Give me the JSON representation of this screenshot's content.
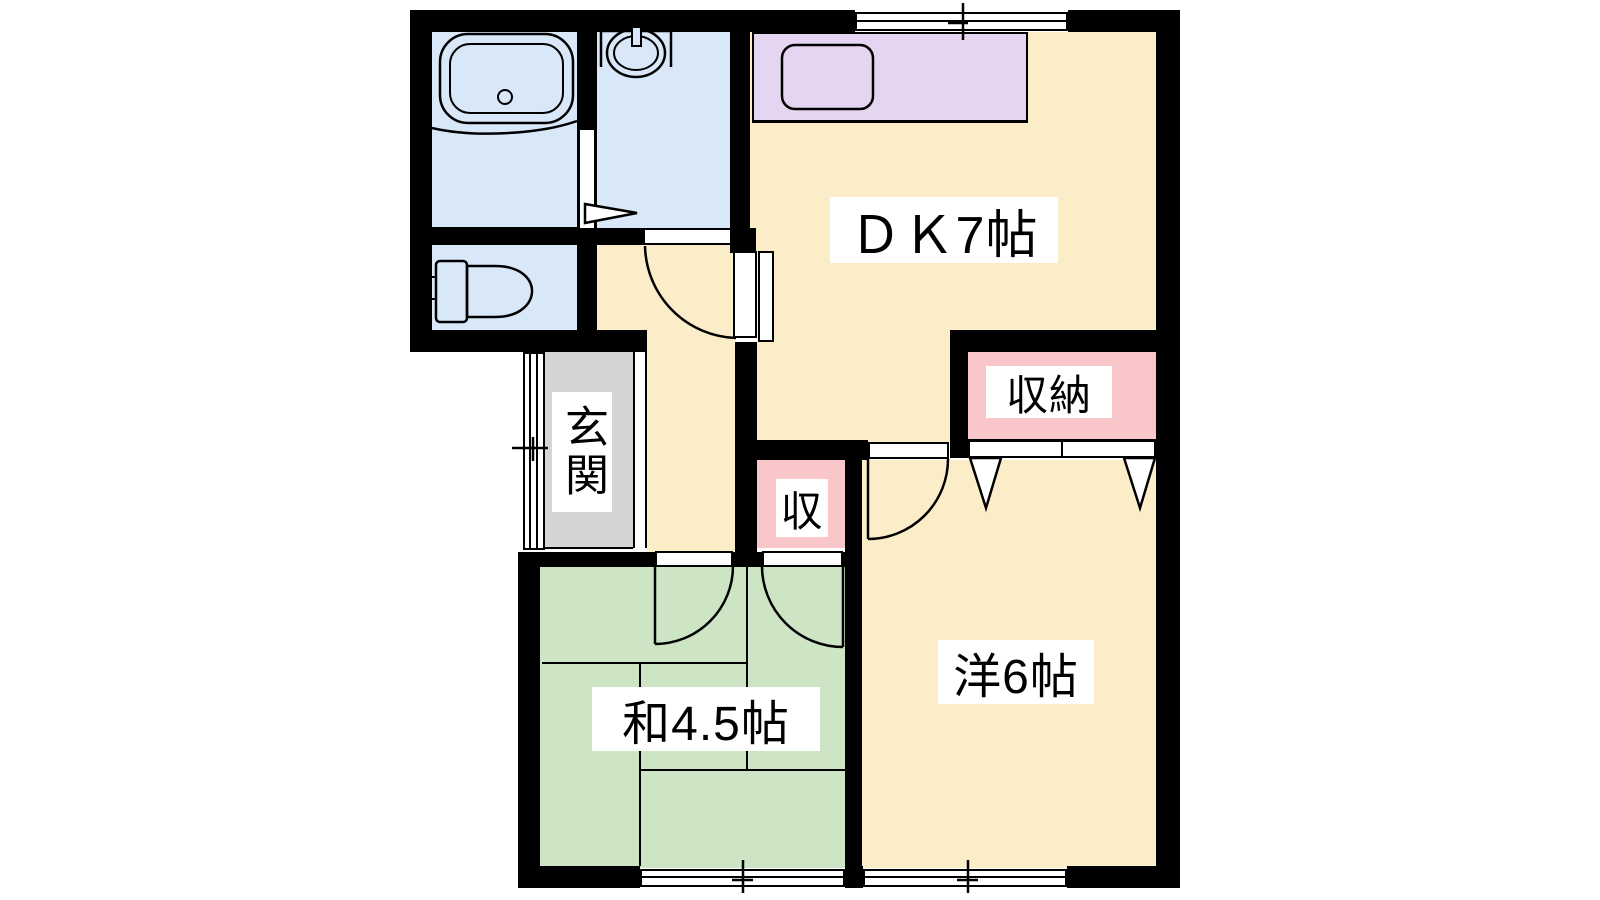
{
  "colors": {
    "background": "#ffffff",
    "wall": "#000000",
    "room_cream": "#FCEDC9",
    "room_green": "#CDE5C5",
    "room_blue": "#D9E8F8",
    "kitchen_purple": "#E6D5F0",
    "closet_pink": "#F9C7C9",
    "entrance_gray": "#D4D4D4",
    "linework": "#000000",
    "label_bg": "#ffffff"
  },
  "labels": {
    "dining_kitchen": "ＤＫ7帖",
    "western_room": "洋6帖",
    "japanese_room": "和4.5帖",
    "entrance": "玄関",
    "closet_large": "収納",
    "closet_small": "収"
  },
  "rooms": [
    {
      "name": "dining-kitchen",
      "label": "ＤＫ7帖",
      "color": "#FCEDC9"
    },
    {
      "name": "western-room",
      "label": "洋6帖",
      "color": "#FCEDC9"
    },
    {
      "name": "japanese-room",
      "label": "和4.5帖",
      "color": "#CDE5C5"
    },
    {
      "name": "entrance",
      "label": "玄関",
      "color": "#D4D4D4"
    },
    {
      "name": "closet-large",
      "label": "収納",
      "color": "#F9C7C9"
    },
    {
      "name": "closet-small",
      "label": "収",
      "color": "#F9C7C9"
    },
    {
      "name": "bathroom",
      "label": "",
      "color": "#D9E8F8"
    },
    {
      "name": "washroom",
      "label": "",
      "color": "#D9E8F8"
    },
    {
      "name": "toilet",
      "label": "",
      "color": "#D9E8F8"
    },
    {
      "name": "hallway",
      "label": "",
      "color": "#FCEDC9"
    }
  ],
  "fixtures": [
    "bathtub",
    "washbasin",
    "toilet-bowl",
    "kitchen-sink"
  ],
  "windows": [
    "top-sliding-window",
    "entrance-sliding-door",
    "japanese-room-window",
    "western-room-window"
  ]
}
